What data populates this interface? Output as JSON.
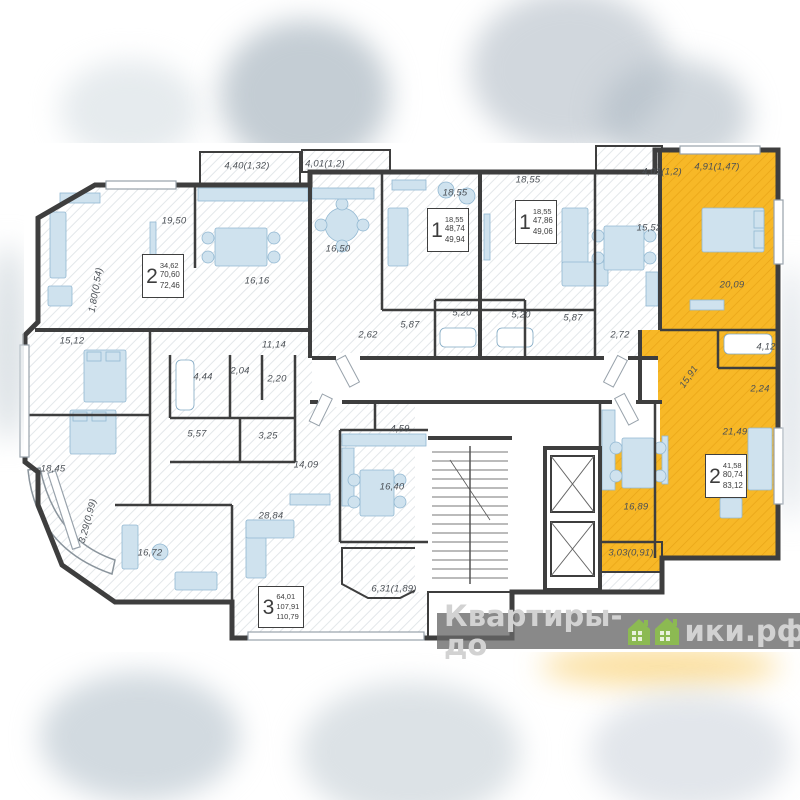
{
  "watermark": {
    "text_before": "Квартиры-до",
    "text_after": "ики.рф"
  },
  "apartments": [
    {
      "number": "2",
      "area_living": "34,62",
      "area_main": "70,60",
      "area_total": "72,46"
    },
    {
      "number": "1",
      "area_living": "18,55",
      "area_main": "48,74",
      "area_total": "49,94"
    },
    {
      "number": "1",
      "area_living": "18,55",
      "area_main": "47,86",
      "area_total": "49,06"
    },
    {
      "number": "2",
      "area_living": "41,58",
      "area_main": "80,74",
      "area_total": "83,12"
    },
    {
      "number": "3",
      "area_living": "64,01",
      "area_main": "107,91",
      "area_total": "110,79"
    }
  ],
  "room_labels": [
    {
      "text": "19,50"
    },
    {
      "text": "16,16"
    },
    {
      "text": "4,40(1,32)"
    },
    {
      "text": "1,80(0,54)"
    },
    {
      "text": "16,50"
    },
    {
      "text": "18,55"
    },
    {
      "text": "4,01(1,2)"
    },
    {
      "text": "5,87"
    },
    {
      "text": "5,20"
    },
    {
      "text": "2,62"
    },
    {
      "text": "18,55"
    },
    {
      "text": "15,52"
    },
    {
      "text": "4,01(1,2)"
    },
    {
      "text": "5,87"
    },
    {
      "text": "5,20"
    },
    {
      "text": "2,72"
    },
    {
      "text": "4,91(1,47)"
    },
    {
      "text": "20,09"
    },
    {
      "text": "4,12"
    },
    {
      "text": "15,91"
    },
    {
      "text": "2,24"
    },
    {
      "text": "21,49"
    },
    {
      "text": "16,89"
    },
    {
      "text": "3,03(0,91)"
    },
    {
      "text": "15,12"
    },
    {
      "text": "11,14"
    },
    {
      "text": "4,44"
    },
    {
      "text": "2,04"
    },
    {
      "text": "2,20"
    },
    {
      "text": "5,57"
    },
    {
      "text": "3,25"
    },
    {
      "text": "18,45"
    },
    {
      "text": "14,09"
    },
    {
      "text": "4,59"
    },
    {
      "text": "16,40"
    },
    {
      "text": "3,29(0,99)"
    },
    {
      "text": "16,72"
    },
    {
      "text": "28,84"
    },
    {
      "text": "6,31(1,89)"
    }
  ],
  "colors": {
    "highlight_yellow": "#F7B827",
    "wall_dark": "#3E3E3E",
    "furniture_blue": "#CFE2EE",
    "watermark_green": "#8CBA52"
  }
}
